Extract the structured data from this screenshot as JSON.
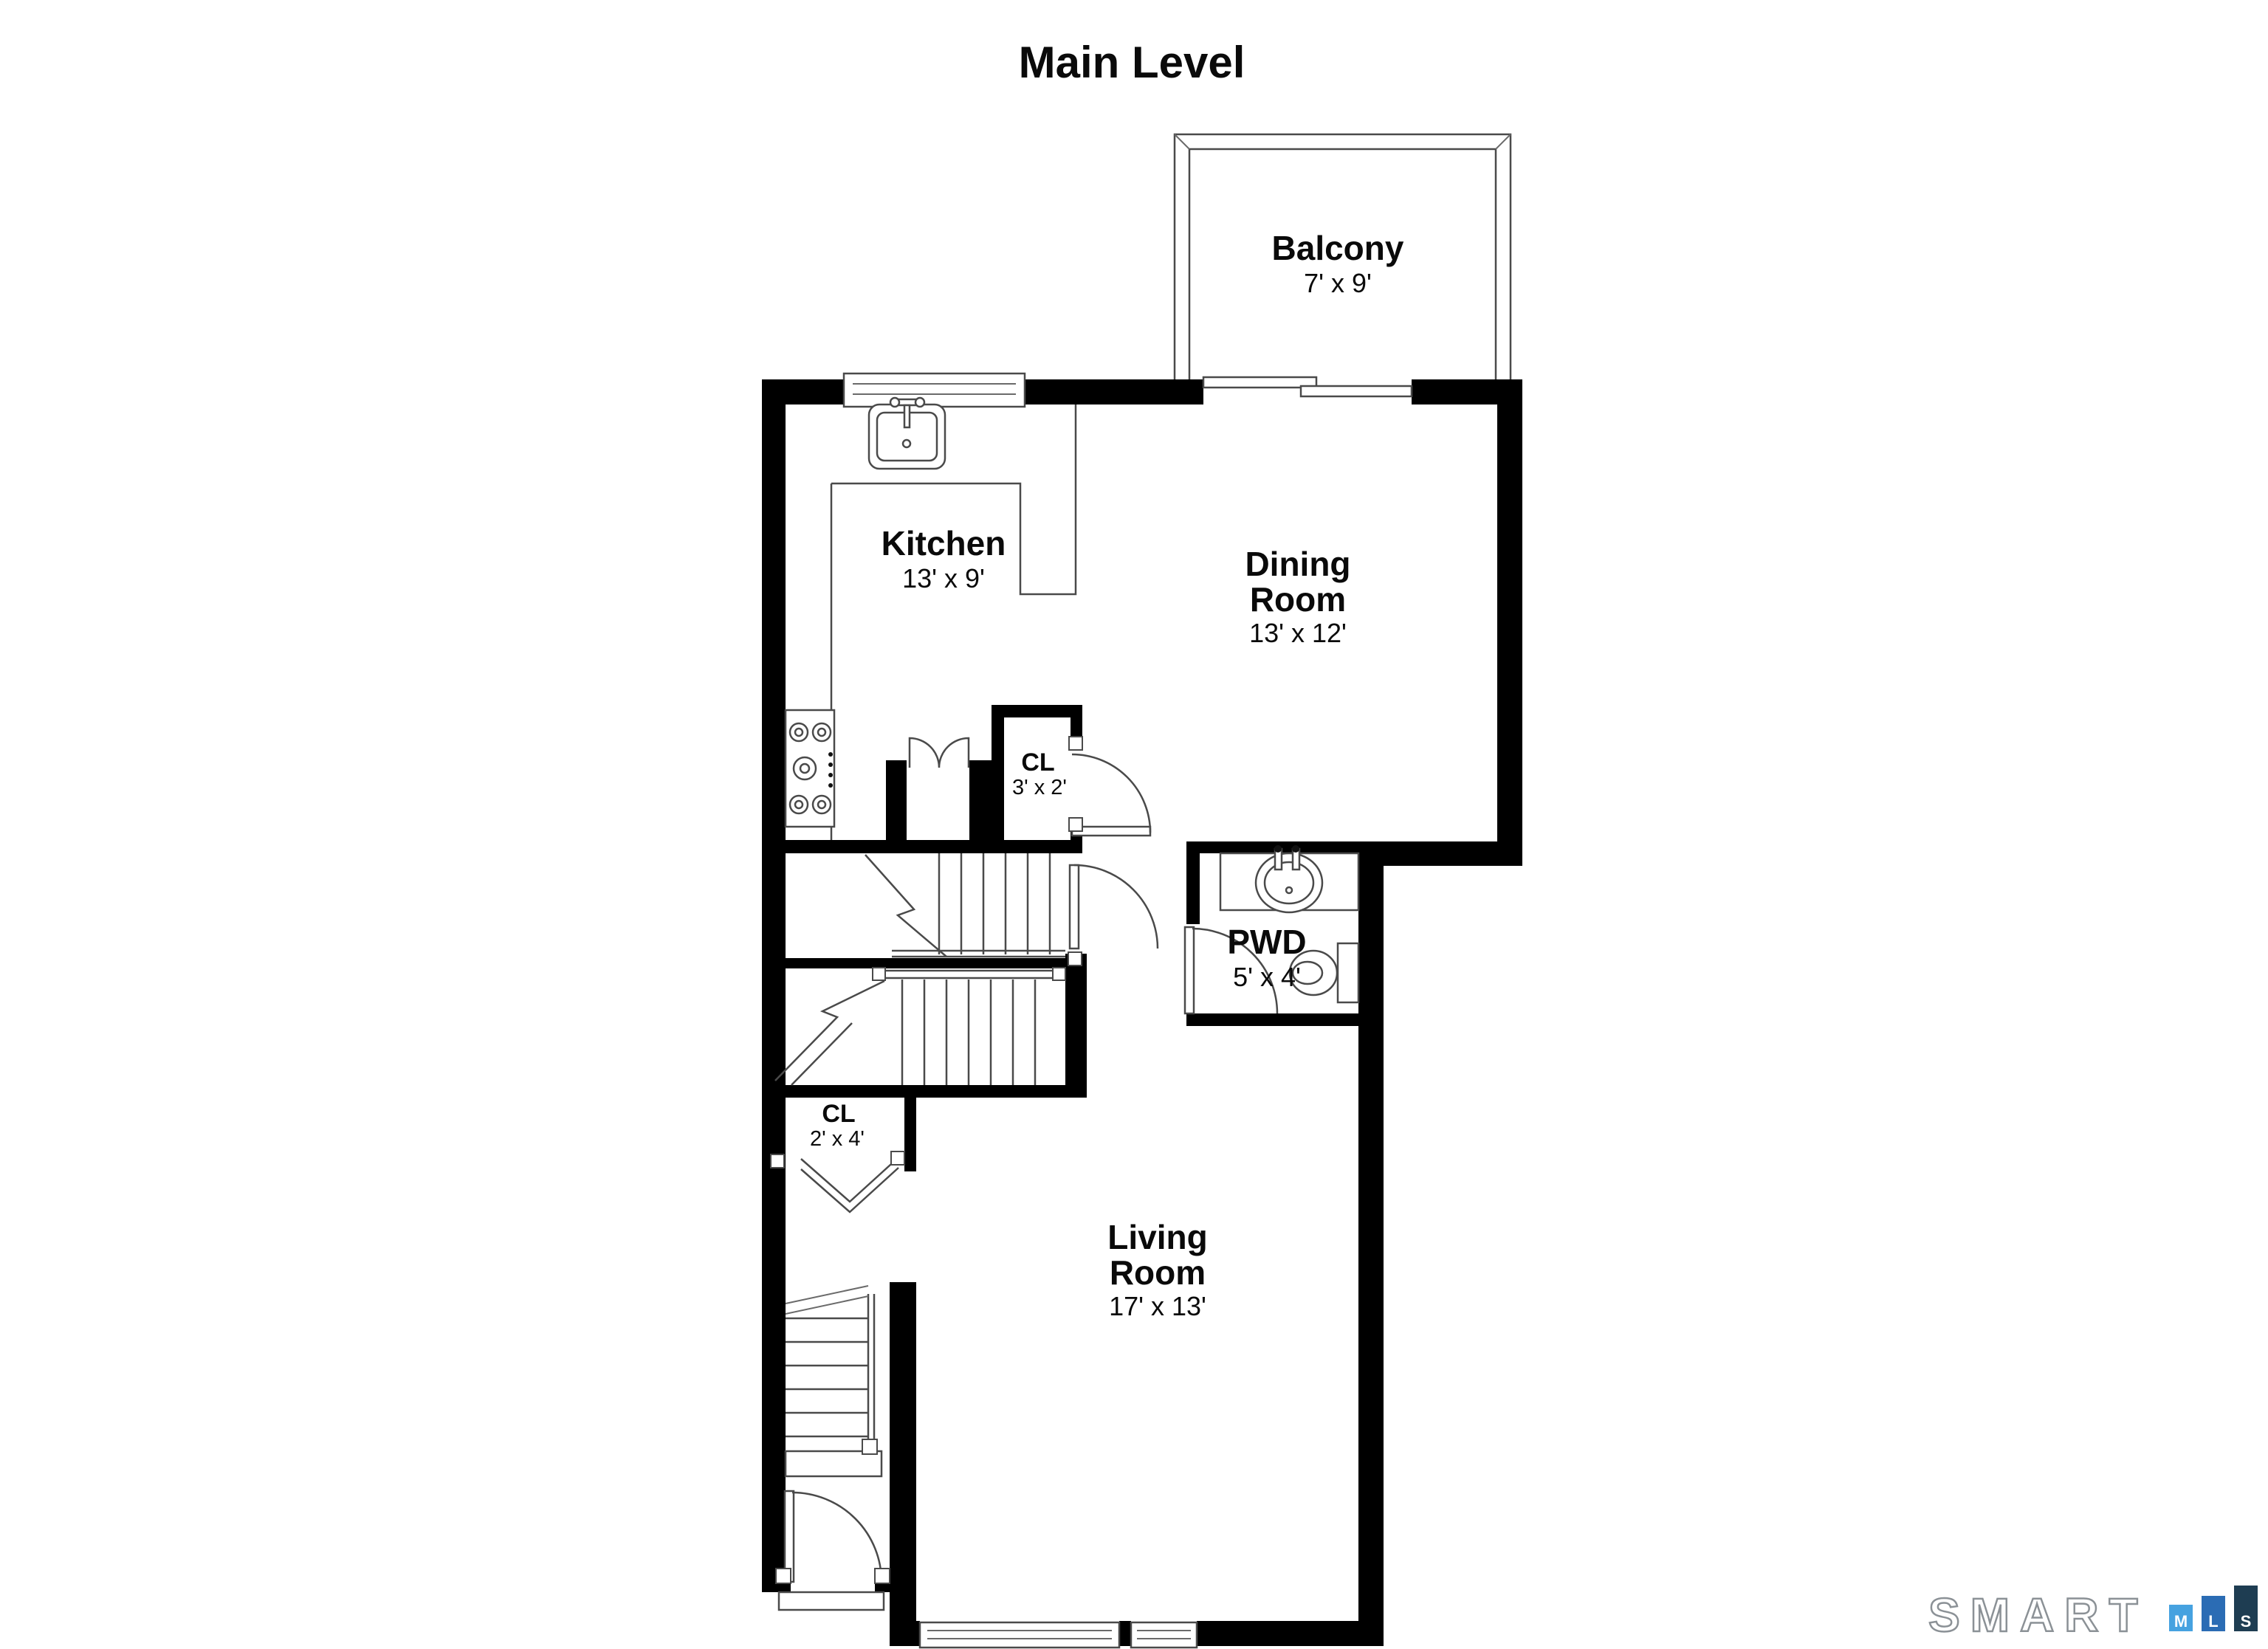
{
  "title": "Main Level",
  "rooms": {
    "balcony": {
      "name": "Balcony",
      "dims": "7' x 9'"
    },
    "kitchen": {
      "name": "Kitchen",
      "dims": "13' x 9'"
    },
    "dining_room": {
      "line1": "Dining",
      "line2": "Room",
      "dims": "13' x 12'"
    },
    "hall_closet": {
      "name": "CL",
      "dims": "3' x 2'"
    },
    "powder_room": {
      "name": "PWD",
      "dims": "5' x 4'"
    },
    "entry_closet": {
      "name": "CL",
      "dims": "2' x 4'"
    },
    "living_room": {
      "line1": "Living",
      "line2": "Room",
      "dims": "17' x 13'"
    }
  },
  "branding": {
    "logo_text": "SMART",
    "bars": [
      {
        "letter": "M",
        "color": "#46A2E0"
      },
      {
        "letter": "L",
        "color": "#2B6CB4"
      },
      {
        "letter": "S",
        "color": "#1E3D52"
      }
    ]
  },
  "colors": {
    "walls": "#000000",
    "thin_line": "#4a4a4a",
    "background": "#ffffff",
    "logo_outline": "#8b9196"
  }
}
